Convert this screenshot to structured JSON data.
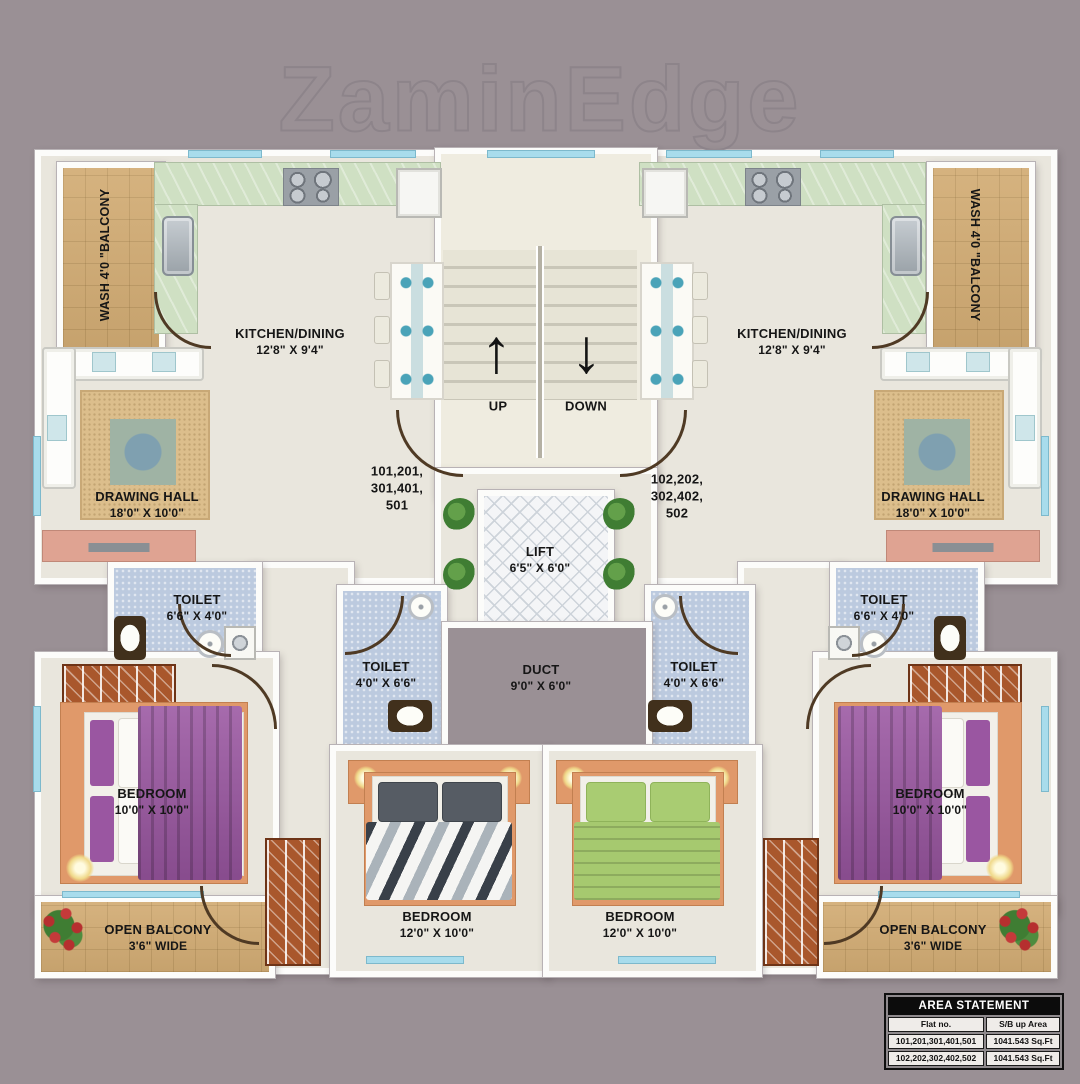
{
  "watermark": "ZaminEdge",
  "icons": {
    "up_arrow": "↑",
    "down_arrow": "↓"
  },
  "stairs": {
    "up_label": "UP",
    "down_label": "DOWN"
  },
  "rooms": {
    "wash_left": {
      "label": "WASH 4'0 \"BALCONY"
    },
    "wash_right": {
      "label": "WASH 4'0 \"BALCONY"
    },
    "kitchen_left": {
      "name": "KITCHEN/DINING",
      "dims": "12'8\" X 9'4\""
    },
    "kitchen_right": {
      "name": "KITCHEN/DINING",
      "dims": "12'8\" X 9'4\""
    },
    "drawing_left": {
      "name": "DRAWING HALL",
      "dims": "18'0\" X 10'0\""
    },
    "drawing_right": {
      "name": "DRAWING HALL",
      "dims": "18'0\" X 10'0\""
    },
    "toilet_left": {
      "name": "TOILET",
      "dims": "6'6\" X 4'0\""
    },
    "toilet_right": {
      "name": "TOILET",
      "dims": "6'6\" X 4'0\""
    },
    "toilet_mid_left": {
      "name": "TOILET",
      "dims": "4'0\" X 6'6\""
    },
    "toilet_mid_right": {
      "name": "TOILET",
      "dims": "4'0\" X 6'6\""
    },
    "lift": {
      "name": "LIFT",
      "dims": "6'5\" X 6'0\""
    },
    "duct": {
      "name": "DUCT",
      "dims": "9'0\" X 6'0\""
    },
    "bedroom_left": {
      "name": "BEDROOM",
      "dims": "10'0\" X 10'0\""
    },
    "bedroom_right": {
      "name": "BEDROOM",
      "dims": "10'0\" X 10'0\""
    },
    "bedroom_mid_left": {
      "name": "BEDROOM",
      "dims": "12'0\" X 10'0\""
    },
    "bedroom_mid_right": {
      "name": "BEDROOM",
      "dims": "12'0\" X 10'0\""
    },
    "balcony_left": {
      "name": "OPEN BALCONY",
      "dims": "3'6\" WIDE"
    },
    "balcony_right": {
      "name": "OPEN BALCONY",
      "dims": "3'6\" WIDE"
    }
  },
  "flats": {
    "left": {
      "line1": "101,201,",
      "line2": "301,401,",
      "line3": "501"
    },
    "right": {
      "line1": "102,202,",
      "line2": "302,402,",
      "line3": "502"
    }
  },
  "area_statement": {
    "title": "AREA STATEMENT",
    "col1": "Flat no.",
    "col2": "S/B up Area",
    "rows": [
      {
        "flat": "101,201,301,401,501",
        "area": "1041.543 Sq.Ft"
      },
      {
        "flat": "102,202,302,402,502",
        "area": "1041.543 Sq.Ft"
      }
    ]
  },
  "colors": {
    "background": "#9a9095",
    "floor": "#e9e6dd",
    "balcony_tile": "#d2ac74",
    "toilet_tile": "#bccadf",
    "kitchen_counter": "#cfe0c3",
    "bed_frame": "#e0996a",
    "blanket_purple": "#9a56a1",
    "blanket_green": "#a6c96f",
    "window_glass": "#a8dcec",
    "door_arc": "#4f3a24"
  }
}
